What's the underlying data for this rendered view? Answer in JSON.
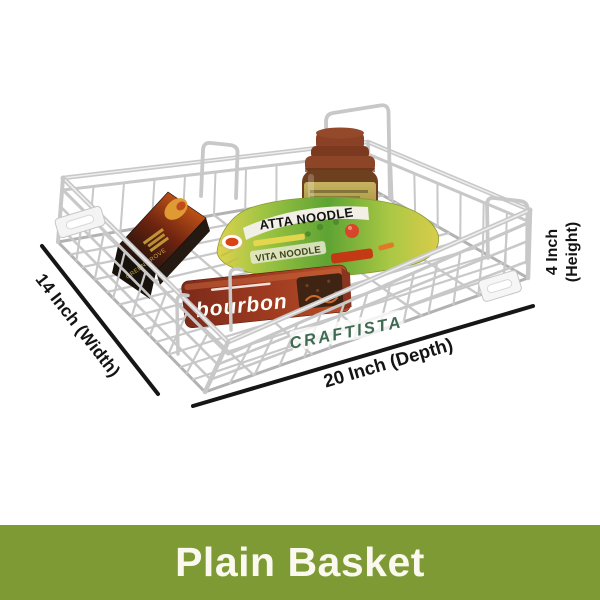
{
  "image_title": "Plain Basket product illustration",
  "banner": {
    "label": "Plain Basket"
  },
  "watermark": {
    "text": "CRAFTISTA"
  },
  "dimensions": {
    "width": "14 Inch (Width)",
    "depth": "20 Inch (Depth)",
    "height_value": "4 Inch",
    "height_unit": "(Height)"
  },
  "products": {
    "noodle_pack": {
      "name": "ATTA NOODLE",
      "subtitle": "VITA NOODLE"
    },
    "biscuit_pack": {
      "name": "bourbon"
    },
    "tea_box": {
      "name": "GREEN TROVE"
    },
    "jar": {
      "description": "brown lidded jar"
    }
  },
  "colors": {
    "banner_green": "#7d9a35",
    "banner_text": "#faf8ef",
    "watermark_green": "#3e6b52",
    "dimension_text": "#141414",
    "line_black": "#161616",
    "wire": "#c8c8c8",
    "wire_light": "#eeeeee",
    "wire_dark": "#b2b2b2",
    "bourbon_red": "#9e3a20",
    "noodle_green": "#5ea334",
    "noodle_yellow": "#ddd34e",
    "box_dark": "#17100b",
    "box_orange": "#c25418",
    "jar_lid_brown": "#8a4126",
    "jar_label_olive": "#b3a04e",
    "bracket_white": "#f4f4f4"
  }
}
